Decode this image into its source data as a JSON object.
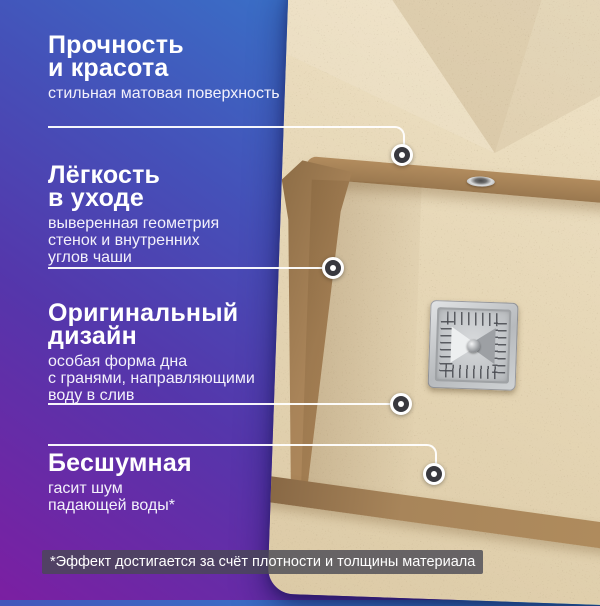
{
  "sections": [
    {
      "heading": "Прочность\nи красота",
      "description": "стильная матовая поверхность"
    },
    {
      "heading": "Лёгкость\nв уходе",
      "description": "выверенная геометрия\nстенок и внутренних\nуглов чаши"
    },
    {
      "heading": "Оригинальный\nдизайн",
      "description": "особая форма дна\nс гранями, направляющими\nводу в слив"
    },
    {
      "heading": "Бесшумная",
      "description": "гасит шум\nпадающей воды*"
    }
  ],
  "footnote": "*Эффект достигается за счёт плотности и толщины материала",
  "photo": {
    "subject": "бежевая гранитная мойка с квадратным сливом",
    "colors": {
      "granite": "#e7d8b8",
      "rim_brown": "#a5825a",
      "drain_chrome": "#c7cacd"
    }
  },
  "icons": {
    "callout_dot": "white-ring-dot-marker",
    "faucet_hole": "chrome-oval-hole",
    "drain": "square-chrome-drain-grate"
  },
  "colors": {
    "gradient_top_right": "#2f8fd0",
    "gradient_middle": "#4550b8",
    "gradient_bottom_left": "#7b1fa2",
    "text": "#ffffff",
    "footnote_bg": "rgba(73,73,84,0.8)"
  }
}
